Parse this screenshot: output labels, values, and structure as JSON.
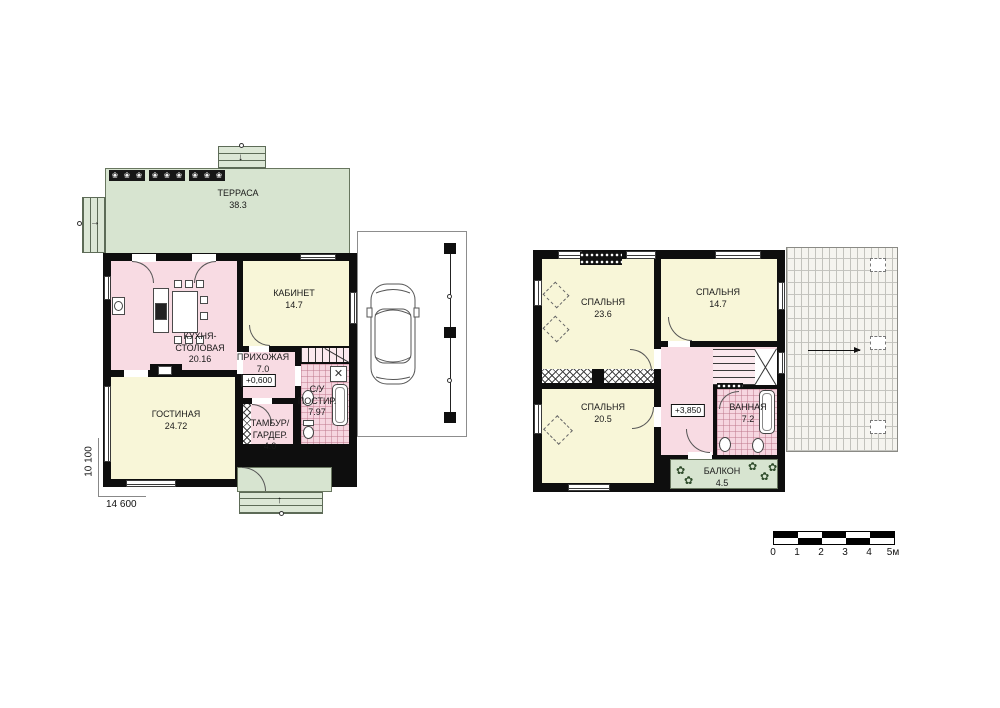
{
  "floor1": {
    "terrace": {
      "name": "ТЕРРАСА",
      "area": "38.3"
    },
    "kitchen": {
      "name": "КУХНЯ-",
      "name2": "СТОЛОВАЯ",
      "area": "20.16"
    },
    "office": {
      "name": "КАБИНЕТ",
      "area": "14.7"
    },
    "hallway": {
      "name": "ПРИХОЖАЯ",
      "area": "7.0",
      "level": "+0,600"
    },
    "living": {
      "name": "ГОСТИНАЯ",
      "area": "24.72"
    },
    "tambour": {
      "name": "ТАМБУР/",
      "name2": "ГАРДЕР.",
      "area": "4.0"
    },
    "wc": {
      "name": "С/У",
      "name2": "ПОСТИР.",
      "area": "7.97"
    },
    "dim_width": "14 600",
    "dim_height": "10 100"
  },
  "floor2": {
    "bedroom_large": {
      "name": "СПАЛЬНЯ",
      "area": "23.6"
    },
    "bedroom_top": {
      "name": "СПАЛЬНЯ",
      "area": "14.7"
    },
    "bedroom_bottom": {
      "name": "СПАЛЬНЯ",
      "area": "20.5"
    },
    "hall": {
      "level": "+3,850"
    },
    "bathroom": {
      "name": "ВАННАЯ",
      "area": "7.2"
    },
    "balcony": {
      "name": "БАЛКОН",
      "area": "4.5"
    }
  },
  "scale_bar": {
    "labels": [
      "0",
      "1",
      "2",
      "3",
      "4",
      "5м"
    ]
  },
  "icons": {
    "flower": "❀",
    "plant": "✿",
    "cross": "✕",
    "arrow_down": "↓",
    "arrow_right": "→",
    "arrow_up": "↑"
  },
  "colors": {
    "wall": "#0e0e0e",
    "terrace_green": "#d7e4d0",
    "room_yellow": "#f8f6d8",
    "room_pink": "#f8dbe3"
  }
}
